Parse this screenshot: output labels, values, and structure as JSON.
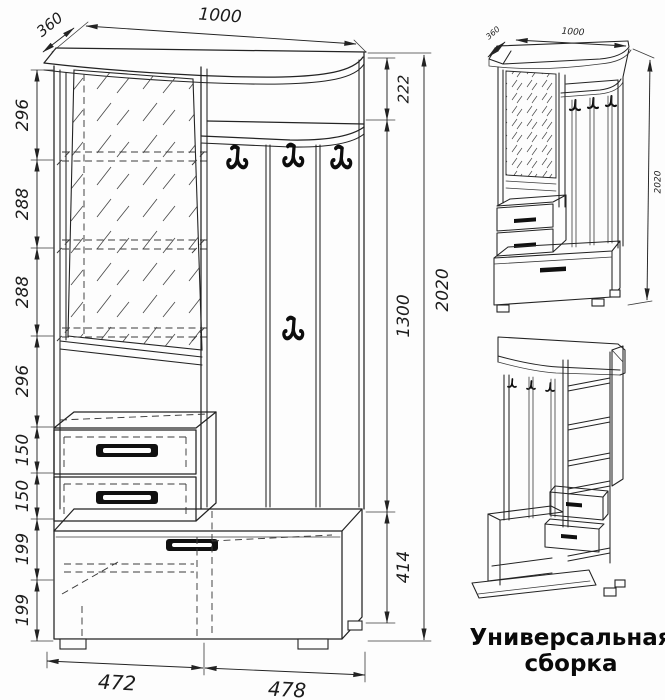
{
  "document": {
    "type": "furniture-technical-drawing",
    "units": "mm"
  },
  "colors": {
    "ink": "#232323",
    "paper": "#fdfdfd",
    "handle": "#101010"
  },
  "main_view": {
    "width_label": "1000",
    "depth_label": "360",
    "height_label": "2020",
    "left_chain": [
      "296",
      "288",
      "288",
      "296",
      "150",
      "150",
      "199",
      "199"
    ],
    "right_chain": [
      "222",
      "1300",
      "414"
    ],
    "bottom_chain": [
      "472",
      "478"
    ]
  },
  "iso_view": {
    "depth_label": "360",
    "width_label": "1000",
    "height_label": "2020"
  },
  "caption": {
    "line1": "Универсальная",
    "line2": "сборка"
  }
}
